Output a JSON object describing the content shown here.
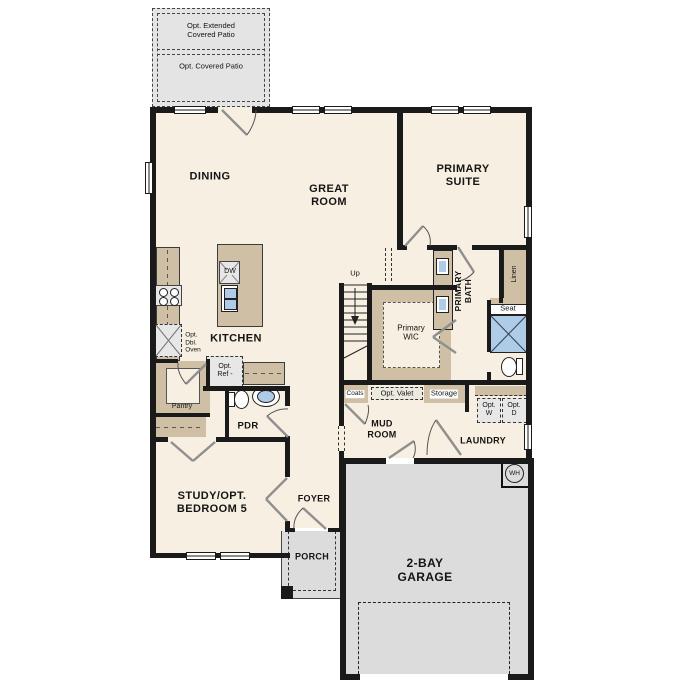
{
  "patio": {
    "extended_label": "Opt. Extended\nCovered Patio",
    "covered_label": "Opt. Covered Patio"
  },
  "rooms": {
    "dining": "DINING",
    "great_room": "GREAT\nROOM",
    "primary_suite": "PRIMARY\nSUITE",
    "kitchen": "KITCHEN",
    "primary_wic": "Primary\nWIC",
    "primary_bath": "PRIMARY\nBATH",
    "pdr": "PDR",
    "mud_room": "MUD\nROOM",
    "laundry": "LAUNDRY",
    "study": "STUDY/OPT.\nBEDROOM 5",
    "foyer": "FOYER",
    "porch": "PORCH",
    "garage": "2-BAY\nGARAGE"
  },
  "fixtures": {
    "dishwasher": "DW",
    "pantry": "Pantry",
    "opt_dbl_oven": "Opt.\nDbl.\nOven",
    "opt_ref": "Opt.\nRef -",
    "stairs_up": "Up",
    "coats": "Coats",
    "opt_valet": "Opt. Valet",
    "storage": "Storage",
    "opt_washer": "Opt.\nW",
    "opt_dryer": "Opt.\nD",
    "linen": "Linen",
    "seat": "Seat",
    "water_heater": "WH"
  },
  "colors": {
    "wall": "#1a1a1a",
    "floor": "#f7efe1",
    "counter_tan": "#cfc0a5",
    "hardscape_gray": "#dcdcdc",
    "fixture_blue": "#aecbe8",
    "appliance_gray": "#e7e7e7"
  }
}
